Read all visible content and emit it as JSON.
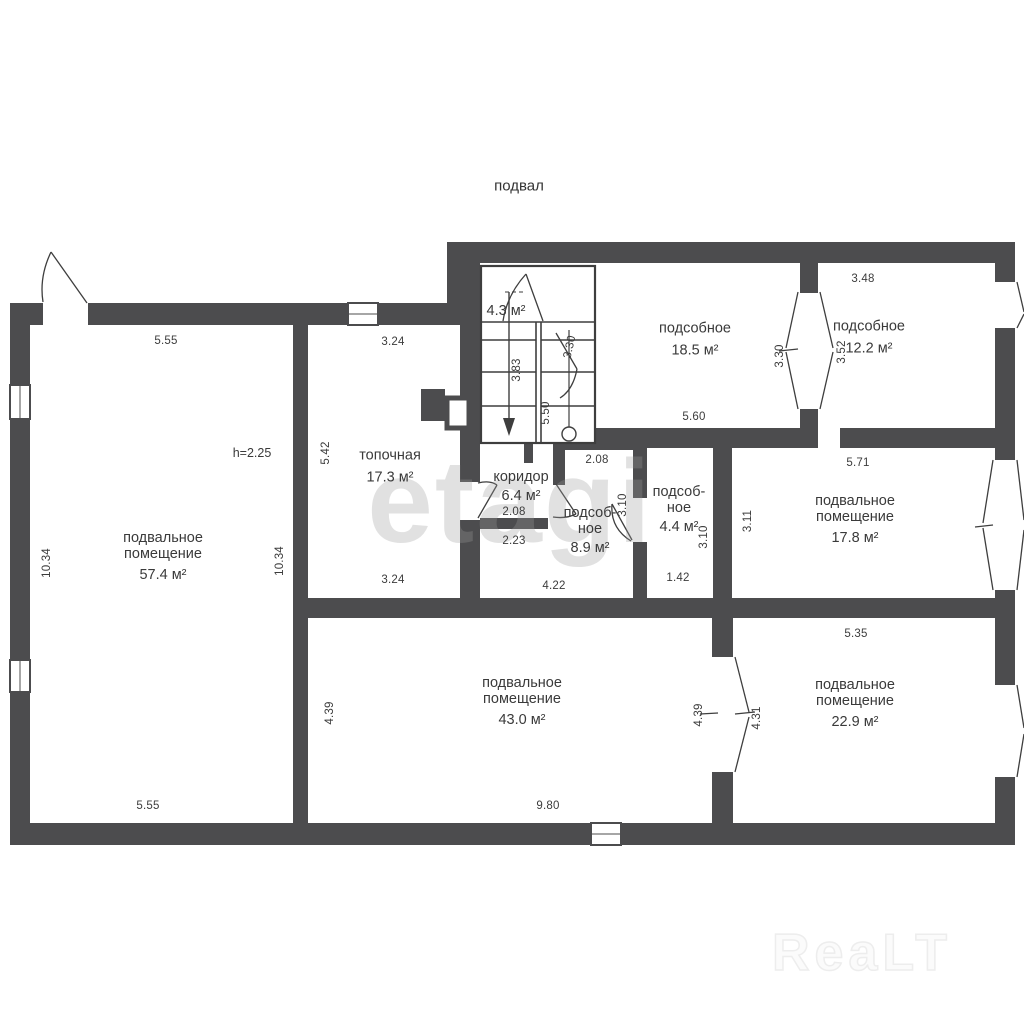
{
  "title": "подвал",
  "watermarks": {
    "center": "etagi",
    "bottom_right": "ReaLT"
  },
  "rooms": {
    "basement_57": {
      "name": "подвальное\nпомещение",
      "area": "57.4 м²",
      "height_note": "h=2.25"
    },
    "boiler": {
      "name": "топочная",
      "area": "17.3 м²"
    },
    "stairs": {
      "area": "4.3 м²"
    },
    "corridor": {
      "name": "коридор",
      "area": "6.4 м²"
    },
    "utility_18": {
      "name": "подсобное",
      "area": "18.5 м²"
    },
    "utility_12": {
      "name": "подсобное",
      "area": "12.2 м²"
    },
    "utility_8": {
      "name": "подсоб-\nное",
      "area": "8.9 м²"
    },
    "utility_4": {
      "name": "подсоб-\nное",
      "area": "4.4 м²"
    },
    "basement_17": {
      "name": "подвальное\nпомещение",
      "area": "17.8 м²"
    },
    "basement_43": {
      "name": "подвальное\nпомещение",
      "area": "43.0 м²"
    },
    "basement_22": {
      "name": "подвальное\nпомещение",
      "area": "22.9 м²"
    }
  },
  "dims": {
    "room57_top": "5.55",
    "room57_left": "10.34",
    "room57_right": "10.34",
    "room57_bottom": "5.55",
    "boiler_top": "3.24",
    "boiler_left": "5.42",
    "boiler_bottom": "3.24",
    "stairs_flight": "3.83",
    "stairs_mid": "5.50",
    "stairs_door": "3.30",
    "u18_bottom": "5.60",
    "door12_left": "3.30",
    "door12_right": "3.52",
    "u12_top": "3.48",
    "corridor_width": "2.08",
    "corridor_bottom": "2.23",
    "u8_top": "2.08",
    "u8_bottom": "4.22",
    "u8_right": "3.10",
    "u4_right": "3.10",
    "u4_bottom": "1.42",
    "b17_top": "5.71",
    "b17_left": "3.11",
    "b43_left": "4.39",
    "b43_right": "4.39",
    "b43_bottom": "9.80",
    "b22_top": "5.35",
    "b22_door": "4.31"
  }
}
